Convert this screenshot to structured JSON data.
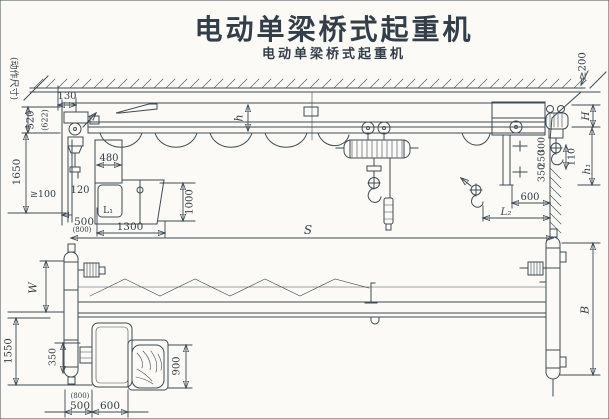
{
  "title": "电动单梁桥式起重机",
  "watermark": "电动单梁桥式起重机",
  "colors": {
    "title": "#0d62ab",
    "ink": "#3f4a54",
    "paper": "#fbfaf6"
  },
  "elevation": {
    "note": "(动作尺寸)",
    "dims": {
      "d130": "130",
      "d520": "520",
      "d622": "(622)",
      "d1650": "1650",
      "dmin100": "≥100",
      "d120": "120",
      "d480": "480",
      "cab_window": "L₁",
      "d1000": "1000",
      "d500": "500",
      "d800": "(800)",
      "d1300": "1300",
      "girder_h": "h",
      "span": "S",
      "dmin200": "≥200",
      "headroom": "H",
      "d110": "110",
      "hook_h1": "h₁",
      "d300": "300",
      "d250": "250",
      "d350": "350",
      "d600": "600",
      "approach_l2": "L₂"
    }
  },
  "plan": {
    "dims": {
      "width_w": "W",
      "d1550": "1550",
      "d350": "350",
      "d900": "900",
      "d800": "(800)",
      "d500": "500",
      "d600": "600",
      "base_b": "B"
    }
  }
}
